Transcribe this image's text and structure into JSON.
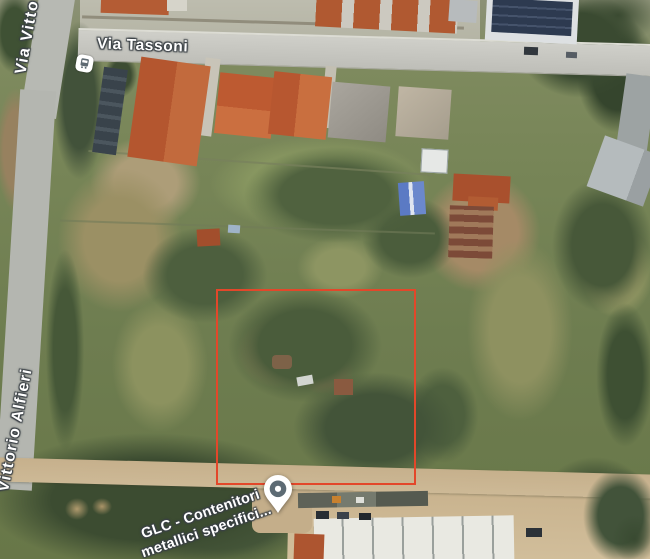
{
  "labels": {
    "road_top": "Via Tassoni",
    "road_left_top": "Via Vitto",
    "road_left_mid": "Vittorio Alfieri",
    "poi_line1": "GLC - Contenitori",
    "poi_line2": "metallici specifici..."
  },
  "markers": {
    "bus_stop_icon": "bus-stop",
    "place_pin_icon": "place-pin"
  },
  "colors": {
    "parcel-outline": "#e3472a",
    "pin-body": "#ffffff",
    "pin-circle": "#5d6b74",
    "pin-dot": "#ffffff",
    "map-label-text": "#ffffff",
    "map-label-halo": "#3a4045",
    "bus-glyph": "#5f6a72"
  }
}
